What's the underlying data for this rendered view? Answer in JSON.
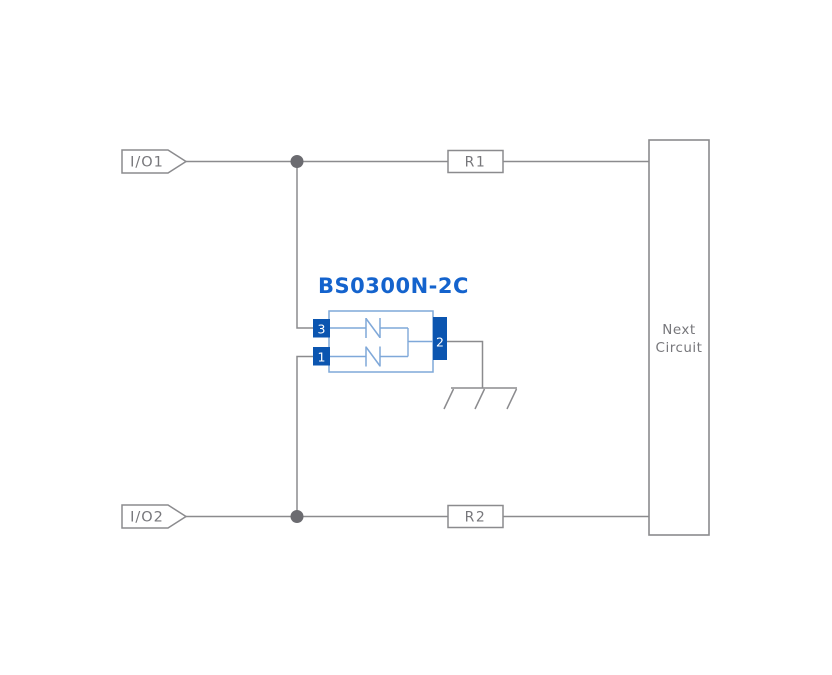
{
  "diagram": {
    "component": {
      "title": "BS0300N-2C",
      "pins": [
        {
          "number": "3",
          "position": "left-top"
        },
        {
          "number": "1",
          "position": "left-bottom"
        },
        {
          "number": "2",
          "position": "right"
        }
      ]
    },
    "io_ports": [
      {
        "label": "I/O1"
      },
      {
        "label": "I/O2"
      }
    ],
    "resistors": [
      {
        "label": "R1"
      },
      {
        "label": "R2"
      }
    ],
    "next_circuit": {
      "line1": "Next",
      "line2": "Circuit"
    },
    "colors": {
      "background": "#ffffff",
      "wire": "#8b8b8e",
      "label_text": "#77777b",
      "junction_dot": "#6b6b70",
      "component_outline": "#7fa8d9",
      "component_pin_fill": "#0b55b0",
      "component_pin_text": "#ffffff",
      "component_title": "#1463cd"
    }
  }
}
